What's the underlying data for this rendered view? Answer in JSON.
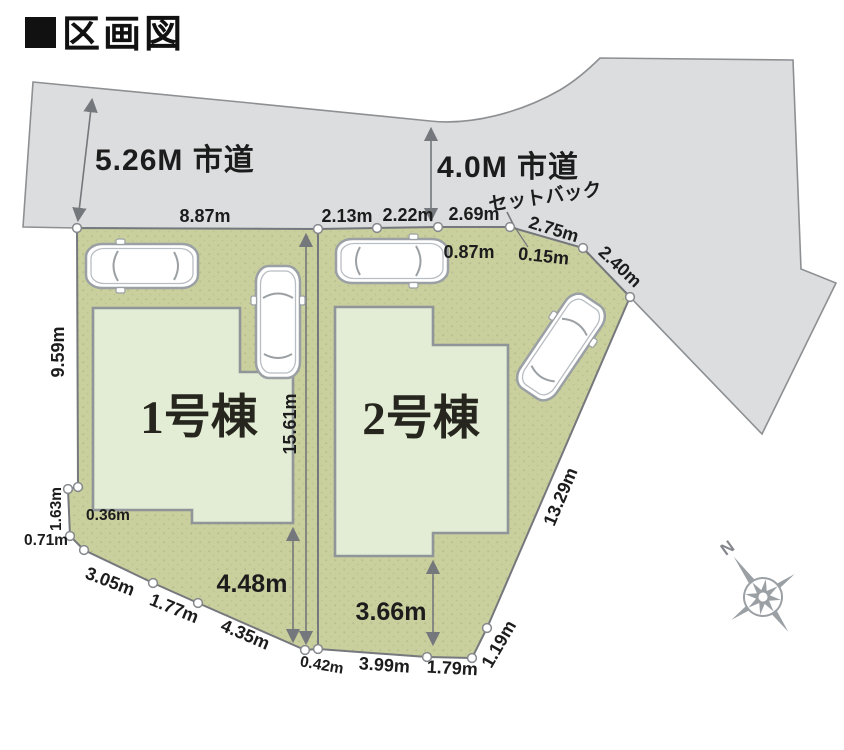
{
  "page": {
    "title": "区画図"
  },
  "roads": {
    "road1": "5.26M 市道",
    "road2": "4.0M 市道",
    "setback": "セットバック"
  },
  "buildings": {
    "b1": "1号棟",
    "b2": "2号棟"
  },
  "compass": {
    "north": "N"
  },
  "dims": {
    "top1": "8.87m",
    "top2": "2.13m",
    "top3": "2.22m",
    "top4": "2.69m",
    "top5": "2.75m",
    "top6": "2.40m",
    "inset1": "0.87m",
    "inset2": "0.15m",
    "left1": "9.59m",
    "left2": "1.63m",
    "left3": "0.36m",
    "left4": "0.71m",
    "bottom1": "3.05m",
    "bottom2": "1.77m",
    "bottom3": "4.35m",
    "bottom4": "0.42m",
    "bottom5": "3.99m",
    "bottom6": "1.79m",
    "bottom7": "1.19m",
    "right1": "13.29m",
    "depth1": "15.61m",
    "depth2": "4.48m",
    "depth3": "3.66m"
  },
  "colors": {
    "road": "#dcddde",
    "lot": "#c9cf9d",
    "lot_dot": "#b7be8b",
    "building_fill": "#e3ecd4",
    "building_stroke": "#8f9599",
    "boundary": "#75787c",
    "text": "#1c1c1c",
    "compass": "#9ba0a5"
  }
}
